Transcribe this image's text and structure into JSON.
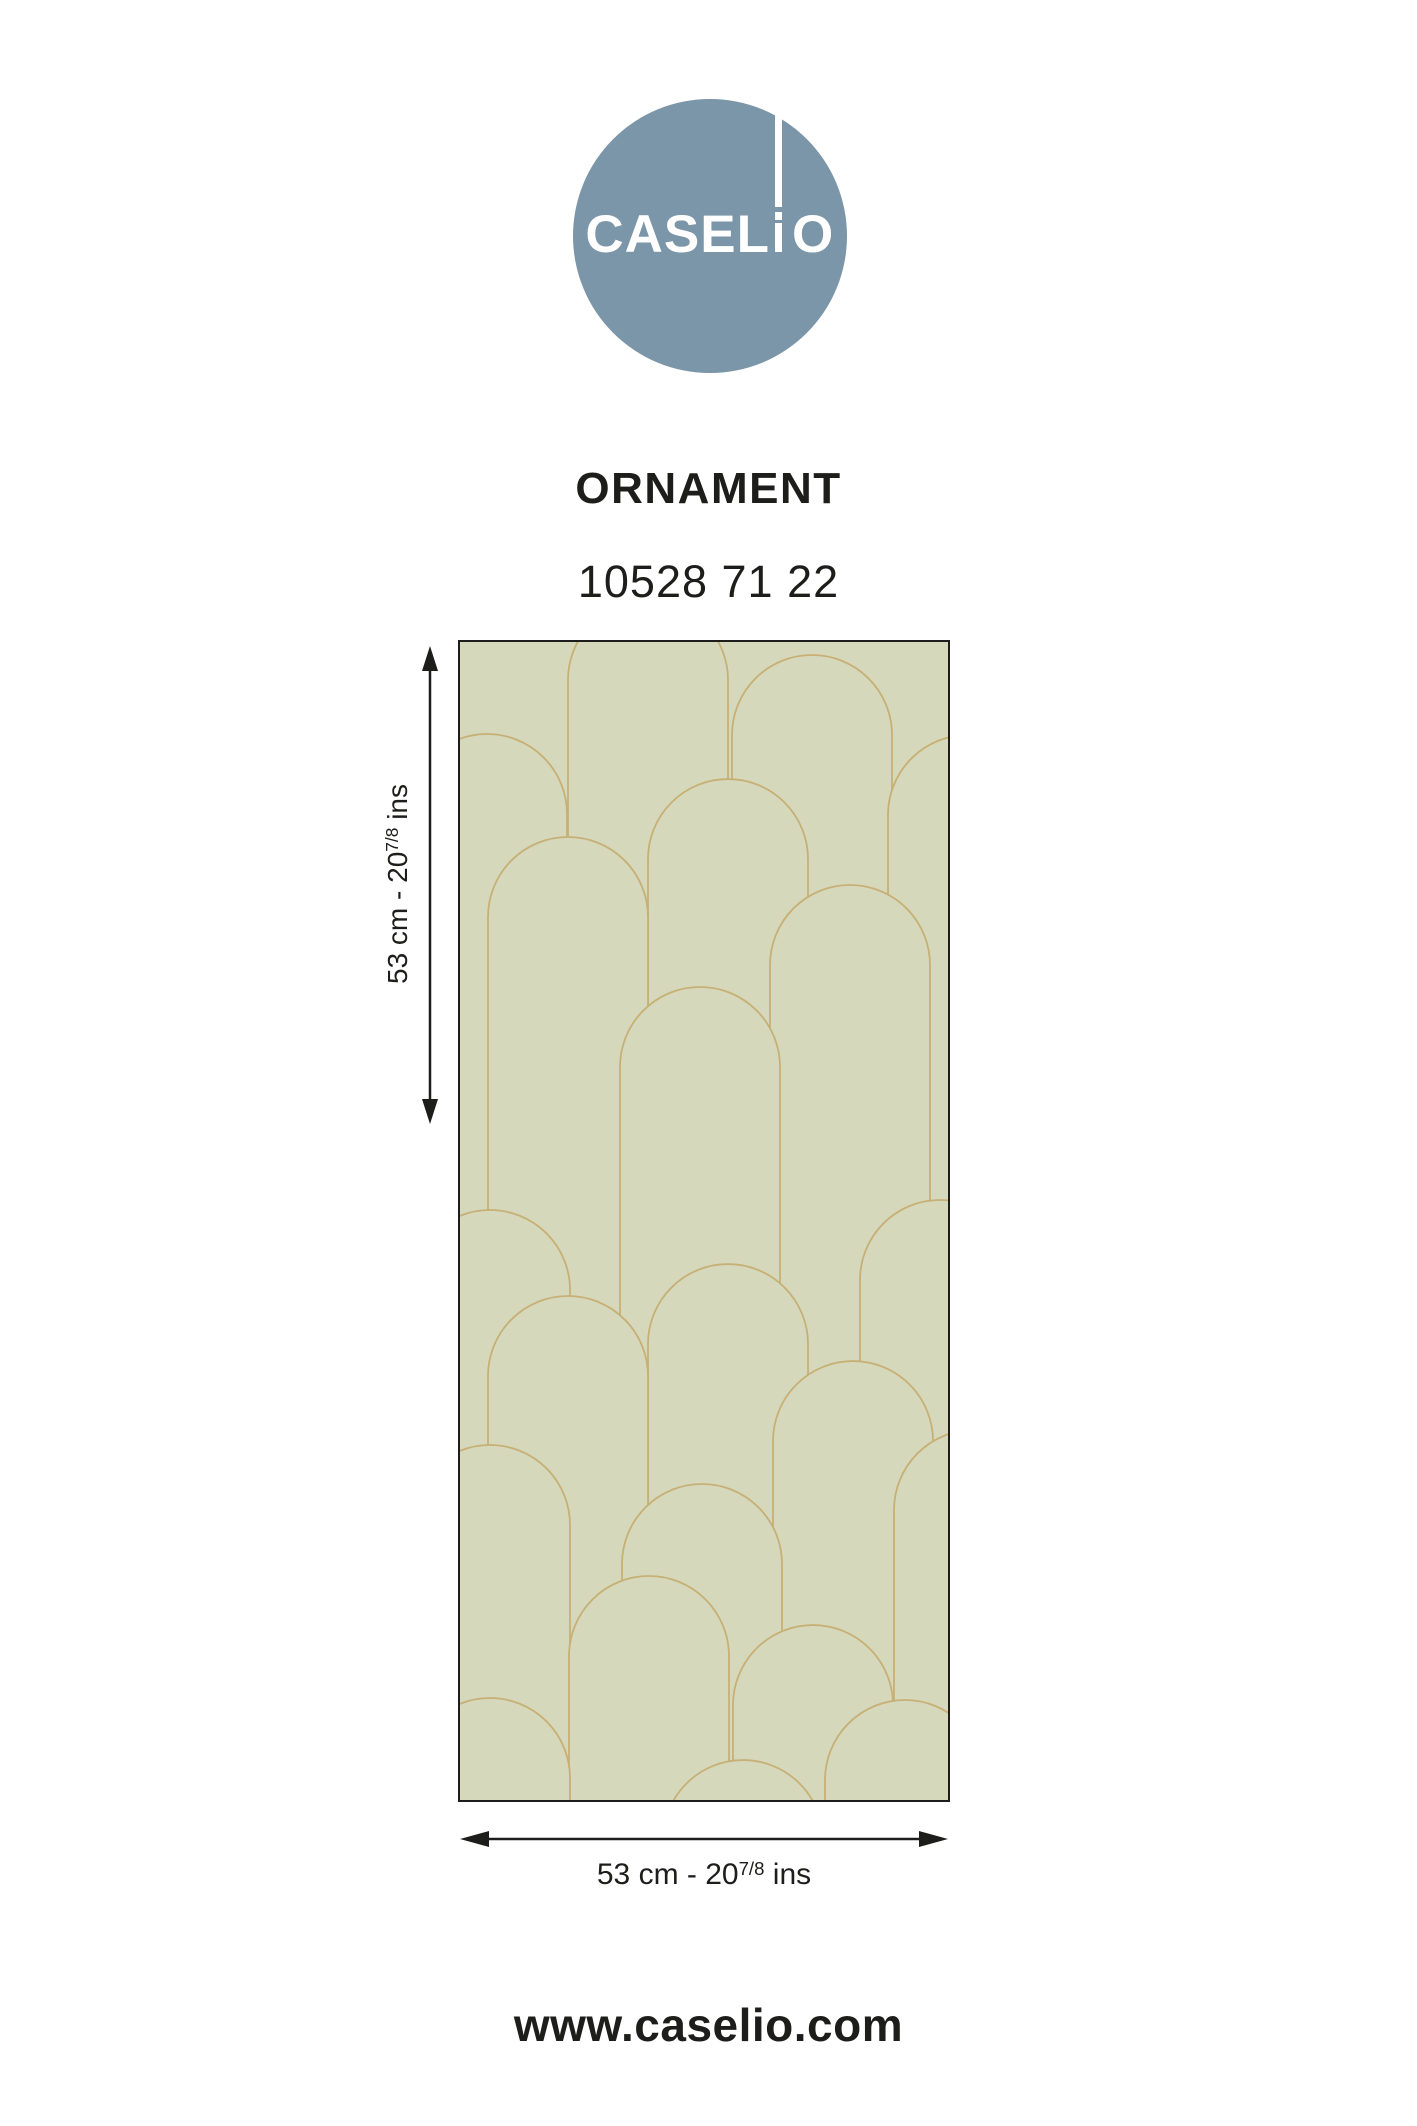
{
  "logo": {
    "brand": "CASELIO",
    "wordmark_left": "CASEL",
    "wordmark_right": "O",
    "circle_color": "#7b95a9"
  },
  "product": {
    "collection": "ORNAMENT",
    "reference": "10528 71 22"
  },
  "swatch": {
    "background": "#d6d8bc",
    "line_color": "#c6b075",
    "border_color": "#1d1d1b"
  },
  "dimensions": {
    "height": {
      "prefix": "53 cm - 20",
      "sup": "7/8",
      "suffix": " ins"
    },
    "width": {
      "prefix": "53 cm - 20",
      "sup": "7/8",
      "suffix": " ins"
    }
  },
  "footer": {
    "website": "www.caselio.com"
  },
  "text_color": "#1d1d1b"
}
